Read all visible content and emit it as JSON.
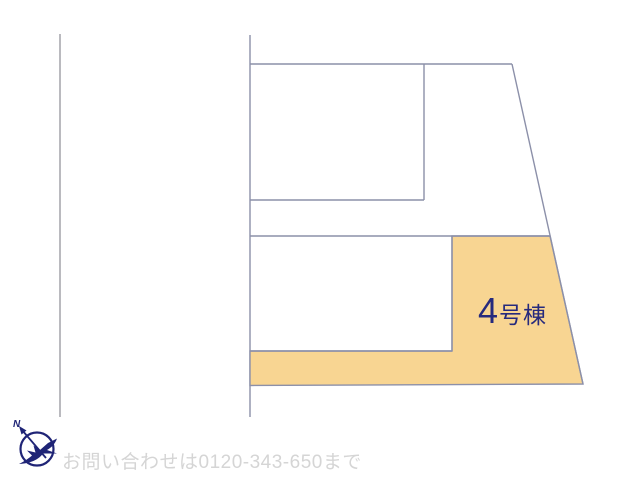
{
  "window": {
    "width": 640,
    "height": 480,
    "background": "#ffffff"
  },
  "site_plan": {
    "parcel_highlight": {
      "number": "4",
      "suffix": "号棟",
      "full_label": "4号棟",
      "fill_color": "#F8D592",
      "label_color": "#262A7D"
    },
    "outline_color": "#8C90A9",
    "road_line_color": "#9C9CA4"
  },
  "compass": {
    "north_label": "N",
    "color": "#1F2476"
  },
  "footer": {
    "contact_text": "お問い合わせは0120-343-650まで",
    "text_color": "#D5D5D5"
  }
}
